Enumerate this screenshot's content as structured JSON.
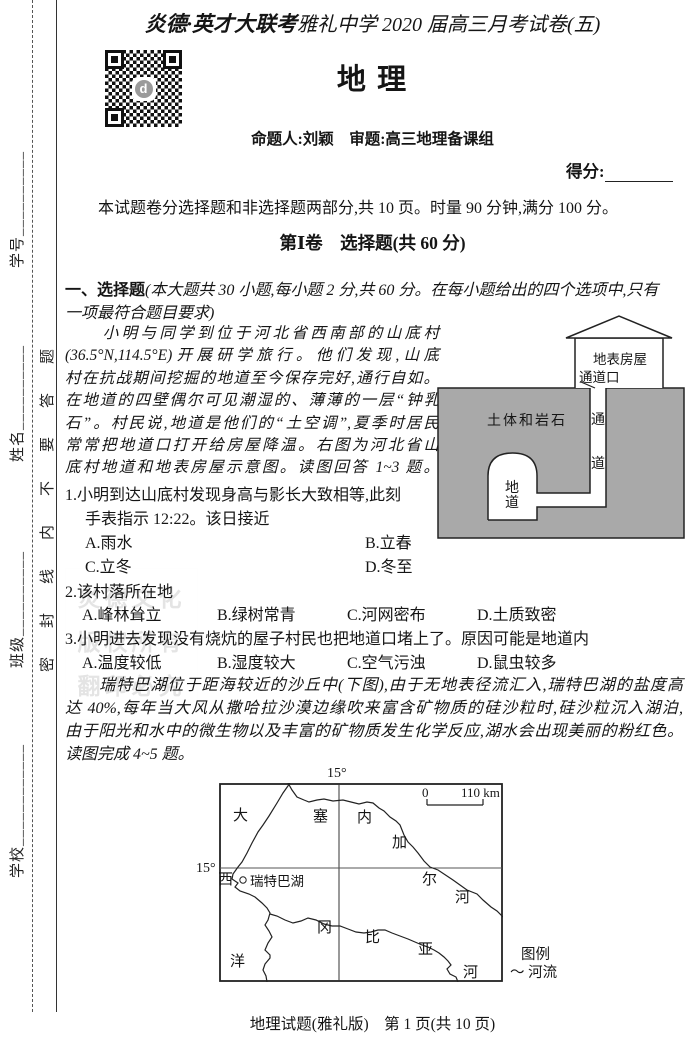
{
  "seal": {
    "school": "学校____________",
    "klass": "班级__________",
    "name": "姓名__________",
    "number": "学号__________",
    "warning": "密封线内不要答题"
  },
  "header": {
    "brand": "炎德·英才大联考",
    "exam_title": "雅礼中学 2020 届高三月考试卷(五)",
    "subject": "地  理",
    "setters": "命题人:刘颖　审题:高三地理备课组",
    "score_label": "得分:",
    "qr_logo_letter": "d"
  },
  "intro": "本试题卷分选择题和非选择题两部分,共 10 页。时量 90 分钟,满分 100 分。",
  "section1": {
    "heading": "第Ⅰ卷　选择题(共 60 分)",
    "lead_bold": "一、选择题",
    "lead_rest": "(本大题共 30 小题,每小题 2 分,共 60 分。在每小题给出的四个选项中,只有",
    "lead_line2": "一项最符合题目要求)"
  },
  "passage1": {
    "lines": [
      "　　小明与同学到位于河北省西南部的山底村",
      "(36.5°N,114.5°E)开展研学旅行。他们发现,山底",
      "村在抗战期间挖掘的地道至今保存完好,通行自如。",
      "在地道的四壁偶尔可见潮湿的、薄薄的一层“钟乳",
      "石”。村民说,地道是他们的“土空调”,夏季时居民",
      "常常把地道口打开给房屋降温。右图为河北省山",
      "底村地道和地表房屋示意图。读图回答 1~3 题。"
    ]
  },
  "tunnel_diagram": {
    "house": "地表房屋",
    "entrance": "通道口",
    "rock": "土体和岩石",
    "shaft_char1": "通",
    "shaft_char2": "道",
    "tunnel_char1": "地",
    "tunnel_char2": "道"
  },
  "q1": {
    "stem_l1": "1.小明到达山底村发现身高与影长大致相等,此刻",
    "stem_l2": "手表指示 12:22。该日接近",
    "optA": "A.雨水",
    "optB": "B.立春",
    "optC": "C.立冬",
    "optD": "D.冬至"
  },
  "q2": {
    "stem": "2.该村落所在地",
    "optA": "A.峰林耸立",
    "optB": "B.绿树常青",
    "optC": "C.河网密布",
    "optD": "D.土质致密"
  },
  "q3": {
    "stem": "3.小明进去发现没有烧炕的屋子村民也把地道口堵上了。原因可能是地道内",
    "optA": "A.温度较低",
    "optB": "B.湿度较大",
    "optC": "C.空气污浊",
    "optD": "D.鼠虫较多"
  },
  "passage2": {
    "lines": [
      "　　瑞特巴湖位于距海较近的沙丘中(下图),由于无地表径流汇入,瑞特巴湖的盐度高",
      "达 40%,每年当大风从撒哈拉沙漠边缘吹来富含矿物质的硅沙粒时,硅沙粒沉入湖泊,",
      "由于阳光和水中的微生物以及丰富的矿物质发生化学反应,湖水会出现美丽的粉红色。",
      "读图完成 4~5 题。"
    ]
  },
  "map_figure": {
    "lon_label": "15°",
    "lat_label": "15°",
    "scale_start": "0",
    "scale_end": "110 km",
    "ocean_1": "大",
    "ocean_2": "西",
    "ocean_3": "洋",
    "river1_1": "塞",
    "river1_2": "内",
    "river1_3": "加",
    "river1_4": "尔",
    "river1_5": "河",
    "lake_label": "瑞特巴湖",
    "river2_1": "冈",
    "river2_2": "比",
    "river2_3": "亚",
    "river2_4": "河",
    "legend_title": "图例",
    "legend_symbol": "～",
    "legend_river": "河流"
  },
  "watermark": {
    "line1": "炎德文化",
    "line2": "版权所有",
    "line3": "翻印必究"
  },
  "footer": "地理试题(雅礼版)　第 1 页(共 10 页)"
}
